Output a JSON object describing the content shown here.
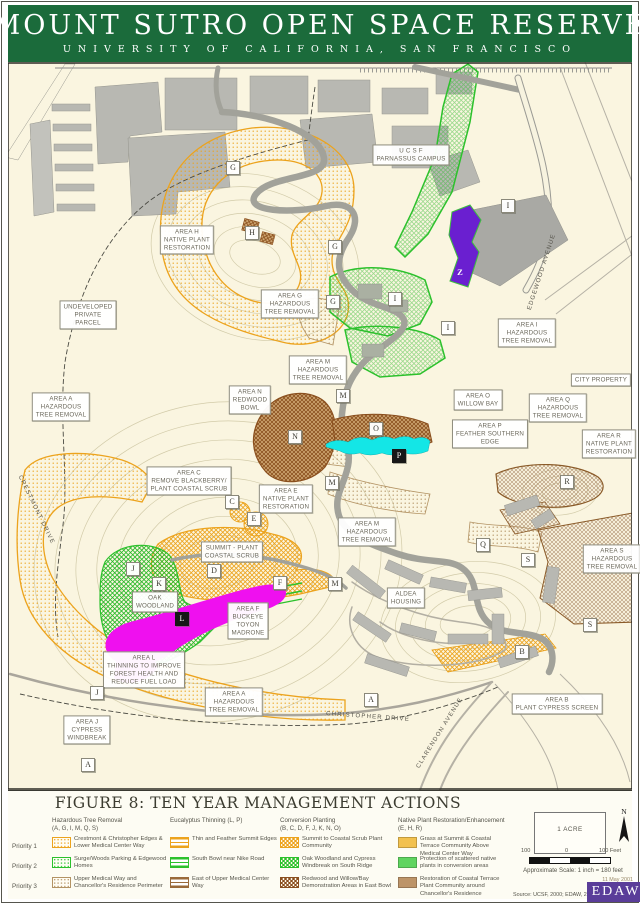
{
  "header": {
    "title": "MOUNT SUTRO OPEN SPACE RESERVE",
    "subtitle": "UNIVERSITY OF CALIFORNIA, SAN FRANCISCO"
  },
  "colors": {
    "banner_green": "#1b6b3b",
    "map_cream": "#faf5e0",
    "hazard_orange": "#eca31d",
    "planting_green": "#2cc12c",
    "thinning_magenta": "#ef10ef",
    "feather_cyan": "#14e6e6",
    "area_z_purple": "#6a1fd0",
    "redwood_brown": "#8a4f1e",
    "tan": "#b39364",
    "edaw_purple": "#5a3d99"
  },
  "map": {
    "labels": [
      {
        "x": 187,
        "y": 240,
        "lines": [
          "AREA H",
          "NATIVE PLANT",
          "RESTORATION"
        ]
      },
      {
        "x": 88,
        "y": 315,
        "lines": [
          "UNDEVELOPED",
          "PRIVATE",
          "PARCEL"
        ]
      },
      {
        "x": 290,
        "y": 304,
        "lines": [
          "AREA G",
          "HAZARDOUS",
          "TREE REMOVAL"
        ]
      },
      {
        "x": 411,
        "y": 155,
        "lines": [
          "U C S F",
          "PARNASSUS CAMPUS"
        ]
      },
      {
        "x": 527,
        "y": 333,
        "lines": [
          "AREA I",
          "HAZARDOUS",
          "TREE REMOVAL"
        ]
      },
      {
        "x": 601,
        "y": 380,
        "lines": [
          "CITY PROPERTY"
        ]
      },
      {
        "x": 61,
        "y": 407,
        "lines": [
          "AREA A",
          "HAZARDOUS",
          "TREE REMOVAL"
        ]
      },
      {
        "x": 318,
        "y": 370,
        "lines": [
          "AREA M",
          "HAZARDOUS",
          "TREE REMOVAL"
        ]
      },
      {
        "x": 250,
        "y": 400,
        "lines": [
          "AREA N",
          "REDWOOD",
          "BOWL"
        ]
      },
      {
        "x": 478,
        "y": 400,
        "lines": [
          "AREA O",
          "WILLOW BAY"
        ]
      },
      {
        "x": 558,
        "y": 408,
        "lines": [
          "AREA Q",
          "HAZARDOUS",
          "TREE REMOVAL"
        ]
      },
      {
        "x": 490,
        "y": 434,
        "lines": [
          "AREA P",
          "FEATHER SOUTHERN",
          "EDGE"
        ]
      },
      {
        "x": 609,
        "y": 444,
        "lines": [
          "AREA R",
          "NATIVE PLANT",
          "RESTORATION"
        ]
      },
      {
        "x": 189,
        "y": 481,
        "lines": [
          "AREA C",
          "REMOVE BLACKBERRY/",
          "PLANT COASTAL SCRUB"
        ]
      },
      {
        "x": 286,
        "y": 499,
        "lines": [
          "AREA E",
          "NATIVE PLANT",
          "RESTORATION"
        ]
      },
      {
        "x": 367,
        "y": 532,
        "lines": [
          "AREA M",
          "HAZARDOUS",
          "TREE REMOVAL"
        ]
      },
      {
        "x": 232,
        "y": 552,
        "lines": [
          "SUMMIT - PLANT",
          "COASTAL SCRUB"
        ]
      },
      {
        "x": 155,
        "y": 602,
        "lines": [
          "OAK",
          "WOODLAND"
        ]
      },
      {
        "x": 248,
        "y": 621,
        "lines": [
          "AREA F",
          "BUCKEYE",
          "TOYON",
          "MADRONE"
        ]
      },
      {
        "x": 144,
        "y": 670,
        "lines": [
          "AREA L",
          "THINNING TO IMPROVE",
          "FOREST HEALTH AND",
          "REDUCE FUEL LOAD"
        ]
      },
      {
        "x": 234,
        "y": 702,
        "lines": [
          "AREA A",
          "HAZARDOUS",
          "TREE REMOVAL"
        ]
      },
      {
        "x": 87,
        "y": 730,
        "lines": [
          "AREA J",
          "CYPRESS",
          "WINDBREAK"
        ]
      },
      {
        "x": 406,
        "y": 598,
        "lines": [
          "ALDEA",
          "HOUSING"
        ]
      },
      {
        "x": 612,
        "y": 559,
        "lines": [
          "AREA S",
          "HAZARDOUS",
          "TREE REMOVAL"
        ]
      },
      {
        "x": 557,
        "y": 704,
        "lines": [
          "AREA B",
          "PLANT CYPRESS SCREEN"
        ]
      }
    ],
    "streets": [
      {
        "x": 36,
        "y": 510,
        "rot": 64,
        "text": "CRESTMONT DRIVE"
      },
      {
        "x": 542,
        "y": 272,
        "rot": -72,
        "text": "EDGEWOOD AVENUE"
      },
      {
        "x": 368,
        "y": 717,
        "rot": 4,
        "text": "CHRISTOPHER DRIVE"
      },
      {
        "x": 440,
        "y": 733,
        "rot": -58,
        "text": "CLARENDON AVENUE"
      }
    ],
    "markers": [
      {
        "x": 233,
        "y": 168,
        "letter": "G",
        "style": "white"
      },
      {
        "x": 252,
        "y": 233,
        "letter": "H",
        "style": "white"
      },
      {
        "x": 335,
        "y": 247,
        "letter": "G",
        "style": "white"
      },
      {
        "x": 333,
        "y": 302,
        "letter": "G",
        "style": "white"
      },
      {
        "x": 508,
        "y": 206,
        "letter": "I",
        "style": "white"
      },
      {
        "x": 395,
        "y": 299,
        "letter": "I",
        "style": "white"
      },
      {
        "x": 448,
        "y": 328,
        "letter": "I",
        "style": "white"
      },
      {
        "x": 460,
        "y": 272,
        "letter": "Z",
        "style": "purple"
      },
      {
        "x": 343,
        "y": 396,
        "letter": "M",
        "style": "white"
      },
      {
        "x": 295,
        "y": 437,
        "letter": "N",
        "style": "white"
      },
      {
        "x": 376,
        "y": 429,
        "letter": "O",
        "style": "white"
      },
      {
        "x": 399,
        "y": 456,
        "letter": "P",
        "style": "black"
      },
      {
        "x": 332,
        "y": 483,
        "letter": "M",
        "style": "white"
      },
      {
        "x": 232,
        "y": 502,
        "letter": "C",
        "style": "white"
      },
      {
        "x": 254,
        "y": 519,
        "letter": "E",
        "style": "white"
      },
      {
        "x": 567,
        "y": 482,
        "letter": "R",
        "style": "white"
      },
      {
        "x": 483,
        "y": 545,
        "letter": "Q",
        "style": "white"
      },
      {
        "x": 528,
        "y": 560,
        "letter": "S",
        "style": "white"
      },
      {
        "x": 590,
        "y": 625,
        "letter": "S",
        "style": "white"
      },
      {
        "x": 335,
        "y": 584,
        "letter": "M",
        "style": "white"
      },
      {
        "x": 522,
        "y": 652,
        "letter": "B",
        "style": "white"
      },
      {
        "x": 371,
        "y": 700,
        "letter": "A",
        "style": "white"
      },
      {
        "x": 133,
        "y": 569,
        "letter": "J",
        "style": "white"
      },
      {
        "x": 159,
        "y": 584,
        "letter": "K",
        "style": "white"
      },
      {
        "x": 214,
        "y": 571,
        "letter": "D",
        "style": "white"
      },
      {
        "x": 280,
        "y": 583,
        "letter": "F",
        "style": "white"
      },
      {
        "x": 182,
        "y": 619,
        "letter": "L",
        "style": "black"
      },
      {
        "x": 97,
        "y": 693,
        "letter": "J",
        "style": "white"
      },
      {
        "x": 88,
        "y": 765,
        "letter": "A",
        "style": "white"
      }
    ]
  },
  "legend": {
    "title": "FIGURE 8: TEN YEAR MANAGEMENT ACTIONS",
    "priorities": [
      "Priority 1",
      "Priority 2",
      "Priority 3"
    ],
    "columns": [
      {
        "header": [
          "Hazardous Tree Removal",
          "(A, G, I, M, Q, S)"
        ],
        "swatch_style": "dots",
        "rows": [
          {
            "color": "#eca31d",
            "label": "Crestmont & Christopher Edges & Lower Medical Center Way"
          },
          {
            "color": "#2cc12c",
            "label": "Surge/Woods Parking & Edgewood Homes"
          },
          {
            "color": "#b39364",
            "label": "Upper Medical Way and Chancellor's Residence Perimeter"
          }
        ]
      },
      {
        "header": [
          "Eucalyptus Thinning (L, P)"
        ],
        "swatch_style": "stripes",
        "rows": [
          {
            "color": "#eca31d",
            "label": "Thin and Feather Summit Edges"
          },
          {
            "color": "#2cc12c",
            "label": "South Bowl near Nike Road"
          },
          {
            "color": "#9a6a3a",
            "label": "East of Upper Medical Center Way"
          }
        ]
      },
      {
        "header": [
          "Conversion Planting",
          "(B, C, D, F, J, K, N, O)"
        ],
        "swatch_style": "cross",
        "rows": [
          {
            "color": "#eca31d",
            "label": "Summit to Coastal Scrub Plant Community"
          },
          {
            "color": "#2cc12c",
            "label": "Oak Woodland and Cypress Windbreak on South Ridge"
          },
          {
            "color": "#8a4f1e",
            "label": "Redwood and Willow/Bay Demonstration Areas in East Bowl"
          }
        ]
      },
      {
        "header": [
          "Native Plant Restoration/Enhancement",
          "(E, H, R)"
        ],
        "swatch_style": "solid",
        "rows": [
          {
            "color": "#f2c14e",
            "label": "Grass at Summit & Coastal Terrace Community Above Medical Center Way"
          },
          {
            "color": "#5fd45f",
            "label": "Protection of scattered native plants in conversion areas"
          },
          {
            "color": "#bd9468",
            "label": "Restoration of Coastal Terrace Plant Community around Chancellor's Residence"
          }
        ]
      }
    ],
    "scale": {
      "acre_label": "1 ACRE",
      "north_label": "N",
      "tick_left": "100",
      "tick_mid": "0",
      "tick_right": "100 Feet",
      "approx": "Approximate Scale: 1 inch = 180 feet",
      "date": "11 May 2001",
      "source": "Source: UCSF, 2000; EDAW, 2000",
      "logo": "EDAW"
    }
  }
}
